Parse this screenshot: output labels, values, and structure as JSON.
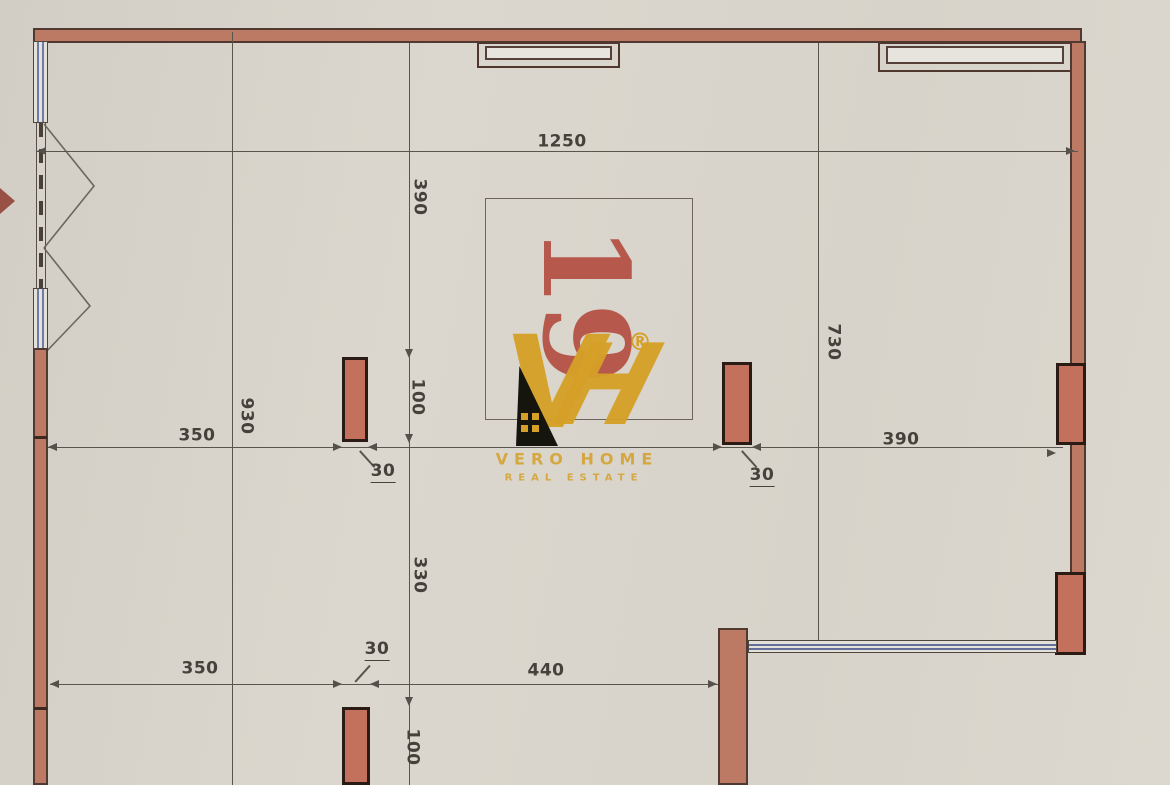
{
  "document": {
    "type": "apartment-floor-plan",
    "unit": {
      "number": "19"
    },
    "dims": {
      "top_width": "1250",
      "left_column_height": "930",
      "upper_height": "390",
      "pillar_height_mid": "100",
      "middle_height": "330",
      "pillar_height_bottom": "100",
      "right_height": "730",
      "mid_left_width": "350",
      "mid_right_width": "390",
      "pillar_width_left": "30",
      "pillar_width_right": "30",
      "bottom_left_width": "350",
      "bottom_pillar_width": "30",
      "bottom_mid_width": "440"
    },
    "watermark": {
      "monogram_v": "V",
      "monogram_h": "H",
      "registered": "®",
      "line1": "VERO HOME",
      "line2": "REAL ESTATE"
    },
    "colors": {
      "paper": "#d8d4cb",
      "wall_fill": "#bc7a64",
      "pillar_fill": "#c3705c",
      "window_blue": "#6f7da6",
      "dimension": "#55504a",
      "unit_red": "#b2473b",
      "brand_gold": "#d6a028"
    }
  }
}
